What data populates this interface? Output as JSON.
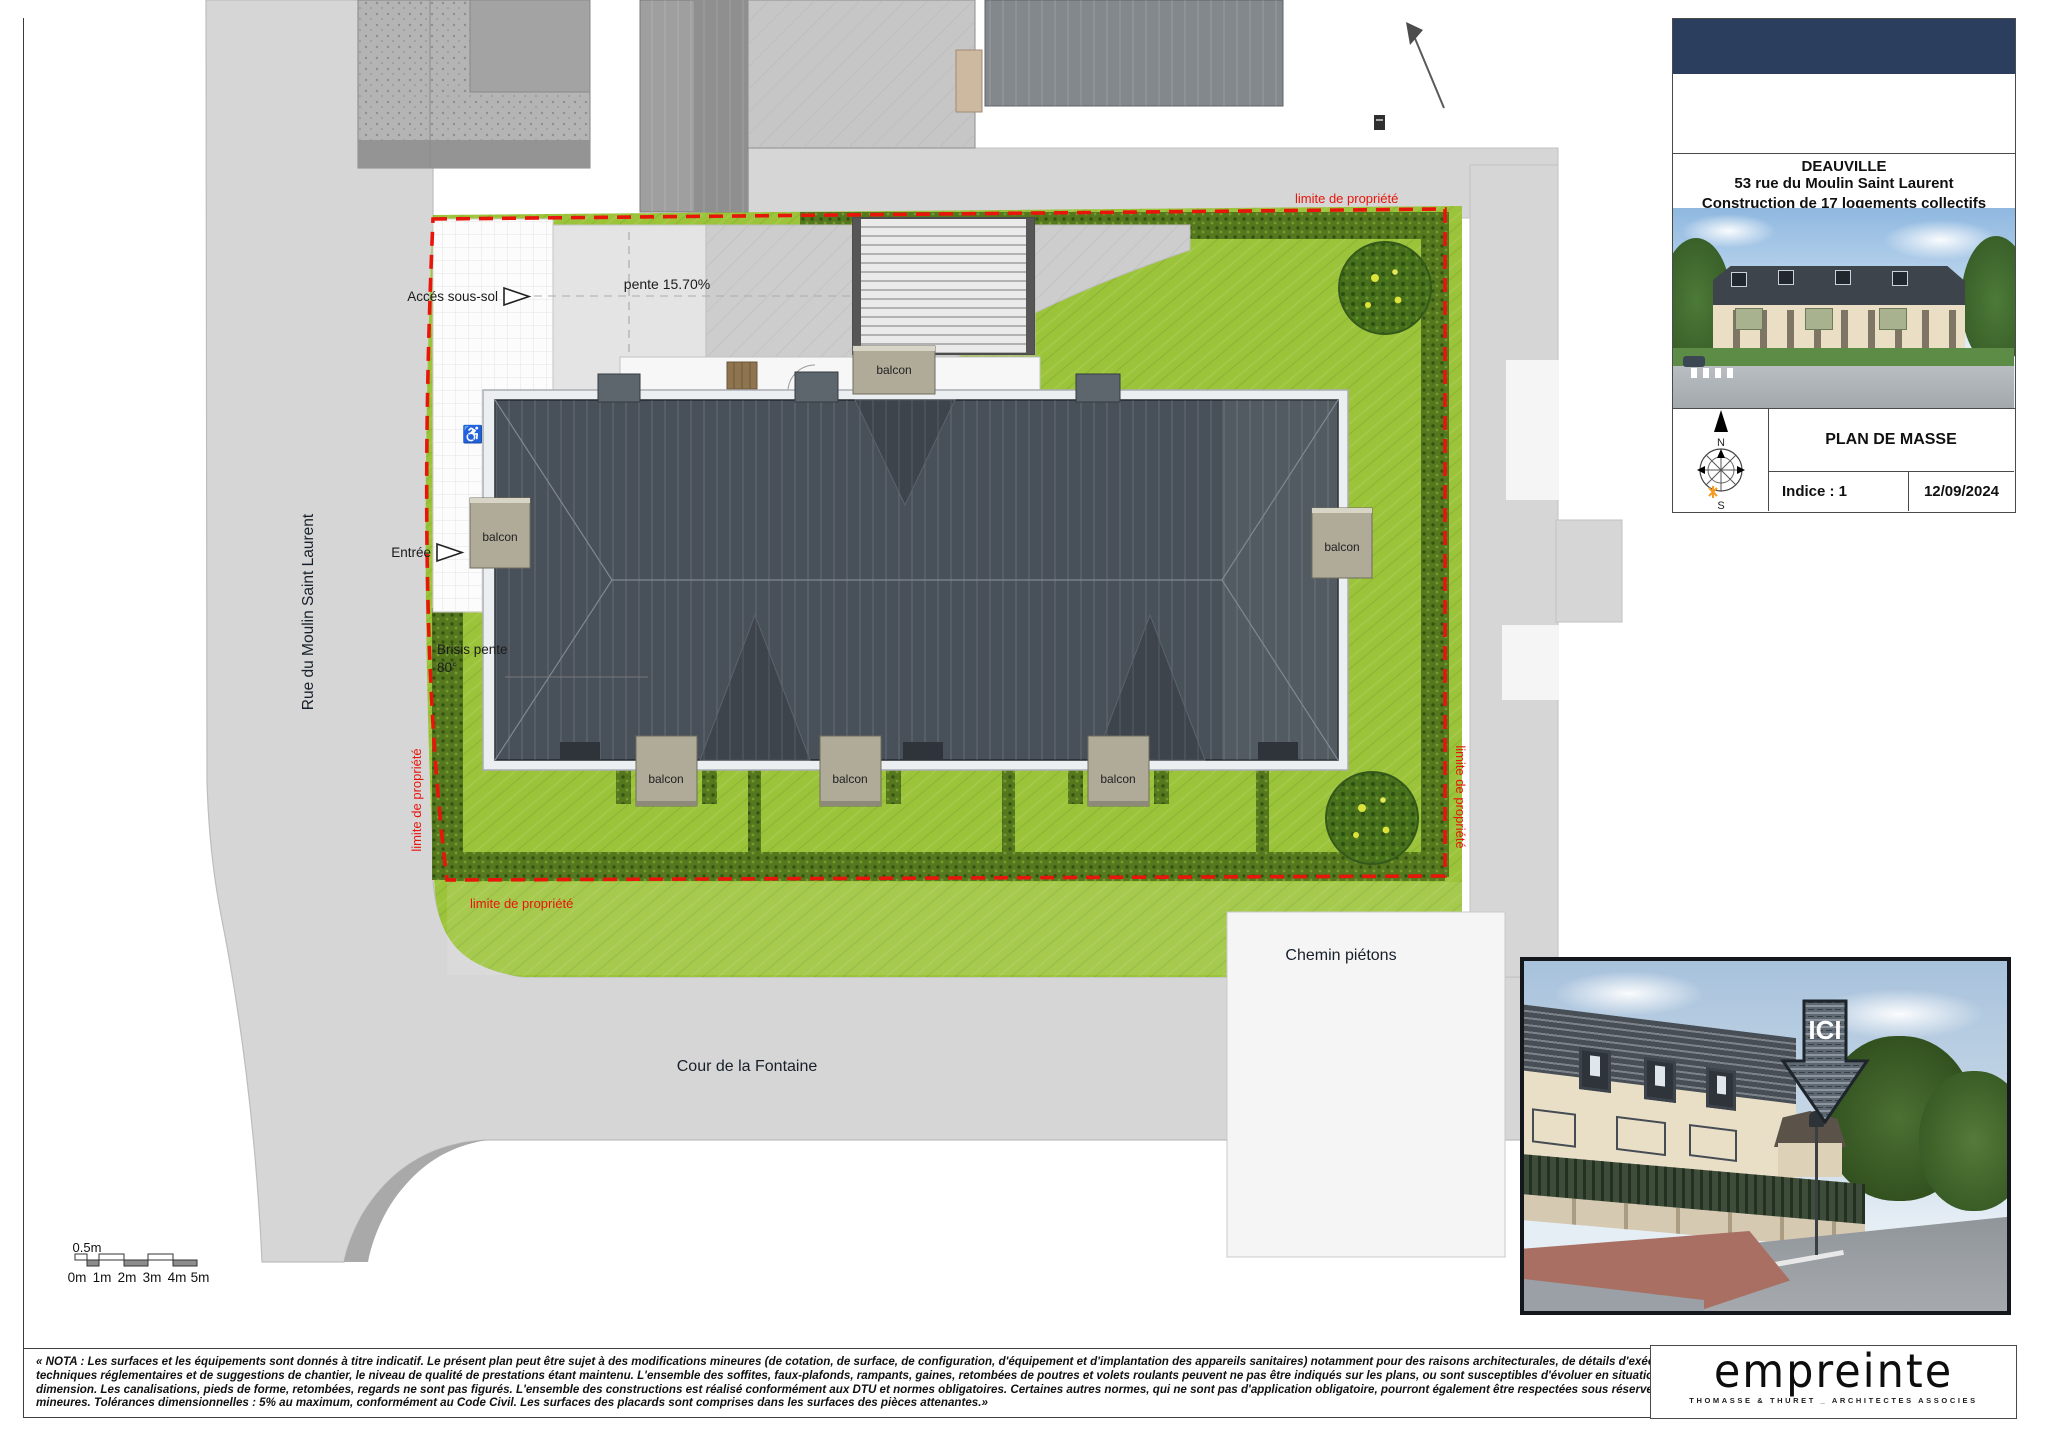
{
  "plan": {
    "street_left": "Rue du Moulin Saint Laurent",
    "street_bottom": "Cour de la Fontaine",
    "footpath": "Chemin piétons",
    "basement_access": "Accés sous-sol",
    "slope": "pente 15.70%",
    "entrance": "Entrée",
    "brisis_1": "Brisis pente",
    "brisis_2": "80°",
    "balcony": "balcon",
    "property_limit": "limite de propriété",
    "accessibility_icon": "♿"
  },
  "titleblock": {
    "city": "DEAUVILLE",
    "address": "53 rue du Moulin Saint Laurent",
    "project": "Construction de 17 logements collectifs",
    "doc_title": "PLAN DE MASSE",
    "indice": "Indice : 1",
    "date": "12/09/2024",
    "compass_n": "N",
    "compass_s": "S"
  },
  "photo": {
    "marker": "ICI"
  },
  "scalebar": {
    "half": "0.5m",
    "marks": [
      "0m",
      "1m",
      "2m",
      "3m",
      "4m",
      "5m"
    ]
  },
  "nota": {
    "lines": [
      "« NOTA : Les surfaces et les équipements sont donnés à titre indicatif. Le présent plan peut être sujet à des modifications mineures (de cotation, de surface, de configuration, d'équipement et d'implantation des appareils sanitaires) notamment pour des raisons architecturales, de détails d'exécution, de",
      "techniques réglementaires et de suggestions de chantier, le niveau de qualité de prestations étant maintenu. L'ensemble des soffites, faux-plafonds, rampants, gaines, retombées de poutres et volets roulants peuvent ne pas être indiqués sur les plans, ou sont susceptibles d'évoluer en situation, en nombre et en",
      "dimension. Les canalisations, pieds de forme, retombées, regards ne sont pas figurés. L'ensemble des constructions est réalisé conformément aux DTU et normes obligatoires. Certaines autres normes, qui ne sont pas d'application obligatoire, pourront également être respectées sous réserve d'adaptations",
      "mineures. Tolérances dimensionnelles : 5% au maximum, conformément au Code Civil. Les surfaces des placards sont comprises dans les surfaces des pièces attenantes.»"
    ]
  },
  "logo": {
    "wordmark": "empreinte",
    "tagline": "THOMASSE & THURET _ ARCHITECTES ASSOCIES"
  },
  "colors": {
    "property_line": "#e8150b",
    "lawn": "#9cc43a",
    "roof": "#485059",
    "navy": "#2c3e5d",
    "road": "#d6d6d6"
  }
}
